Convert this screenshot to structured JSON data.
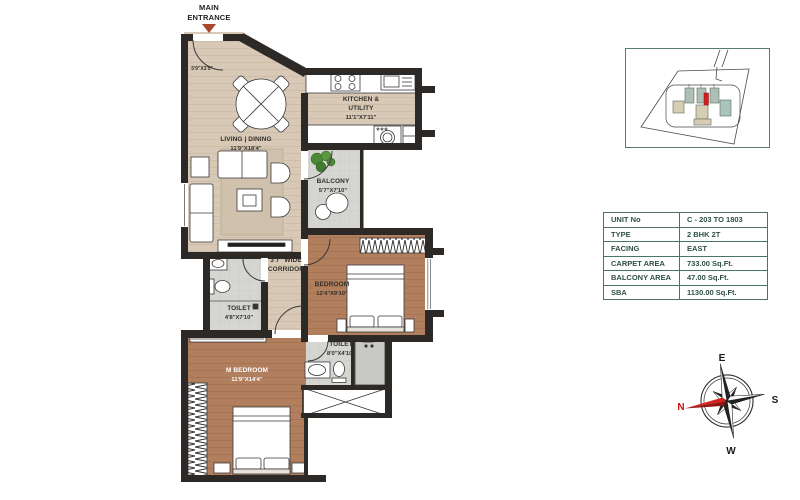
{
  "entrance": {
    "label": "MAIN ENTRANCE"
  },
  "plan": {
    "foyer": {
      "dim": "5'9\"X3'5\""
    },
    "living": {
      "name": "LIVING | DINING",
      "dim": "11'9\"X18'4\""
    },
    "kitchen": {
      "name": "KITCHEN & UTILITY",
      "dim": "11'1\"X7'11\""
    },
    "balcony": {
      "name": "BALCONY",
      "dim": "5'7\"X7'10\""
    },
    "corridor": {
      "name": "3'7\" WIDE CORRIDOR"
    },
    "bedroom": {
      "name": "BEDROOM",
      "dim": "12'4\"X9'10\""
    },
    "toilet1": {
      "name": "TOILET",
      "dim": "4'8\"X7'10\""
    },
    "toilet2": {
      "name": "TOILET",
      "dim": "8'0\"X4'10\""
    },
    "master_bedroom": {
      "name": "M BEDROOM",
      "dim": "11'9\"X14'4\""
    }
  },
  "unit_table": {
    "rows": [
      {
        "label": "UNIT No",
        "value": "C - 203 TO 1803"
      },
      {
        "label": "TYPE",
        "value": "2 BHK 2T"
      },
      {
        "label": "FACING",
        "value": "EAST"
      },
      {
        "label": "CARPET AREA",
        "value": "733.00 Sq.Ft."
      },
      {
        "label": "BALCONY AREA",
        "value": "47.00 Sq.Ft."
      },
      {
        "label": "SBA",
        "value": "1130.00 Sq.Ft."
      }
    ]
  },
  "compass": {
    "east": "E",
    "south": "S",
    "west": "W",
    "north": "N"
  },
  "colors": {
    "wall": "#2c2926",
    "floor_beige": "#d7c9b6",
    "floor_brown": "#b17f5e",
    "floor_gray": "#d5d5d1",
    "accent_red": "#c22121",
    "table_border": "#4a7468",
    "table_text": "#2f4f47",
    "entrance_arrow": "#a8452a"
  }
}
